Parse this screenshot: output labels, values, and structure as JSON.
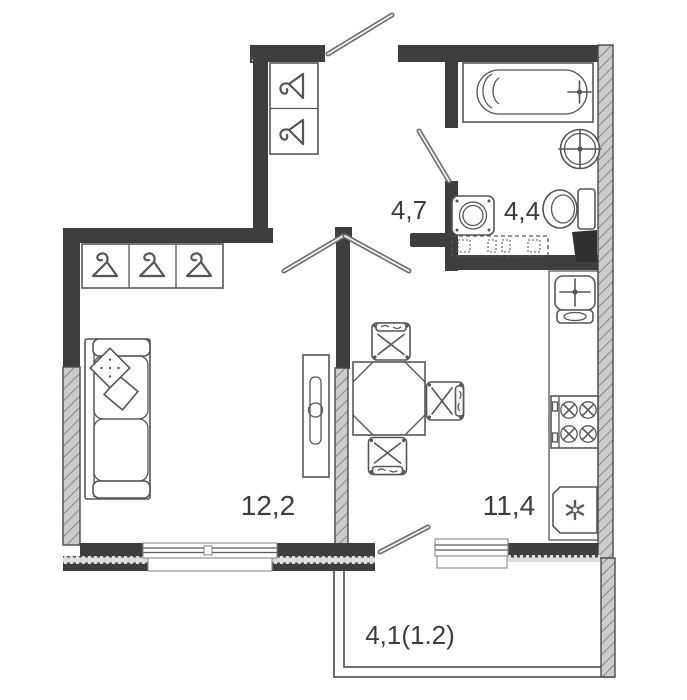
{
  "plan": {
    "type": "apartment-floor-plan",
    "rooms": {
      "hall": {
        "id": "hallway",
        "area_label": "4,7"
      },
      "bath": {
        "id": "bathroom",
        "area_label": "4,4"
      },
      "living": {
        "id": "living-room",
        "area_label": "12,2"
      },
      "kitchen": {
        "id": "kitchen",
        "area_label": "11,4"
      },
      "balcony": {
        "id": "balcony",
        "area_label": "4,1(1.2)"
      }
    },
    "colors": {
      "wall": "#3e3e3e",
      "wall_hatch_bg": "#cbcbcb",
      "wall_hatch_line": "#737373",
      "fixture_outline": "#565656",
      "label_text": "#3c3c3c",
      "background": "#ffffff"
    },
    "fixtures": [
      "entry-door",
      "entry-closet-2-hangers",
      "wardrobe-3-hangers",
      "hall-double-door",
      "bathroom-door",
      "bathtub",
      "washbasin",
      "toilet",
      "washing-machine",
      "planned-cabinet-dashed",
      "vent-duct",
      "kitchen-counter",
      "kitchen-sink",
      "stove-4-burners",
      "fridge",
      "sofa-with-pillows",
      "tv-stand",
      "dining-table",
      "chairs-3",
      "living-window",
      "kitchen-window-balcony-door",
      "balcony-outline"
    ]
  }
}
